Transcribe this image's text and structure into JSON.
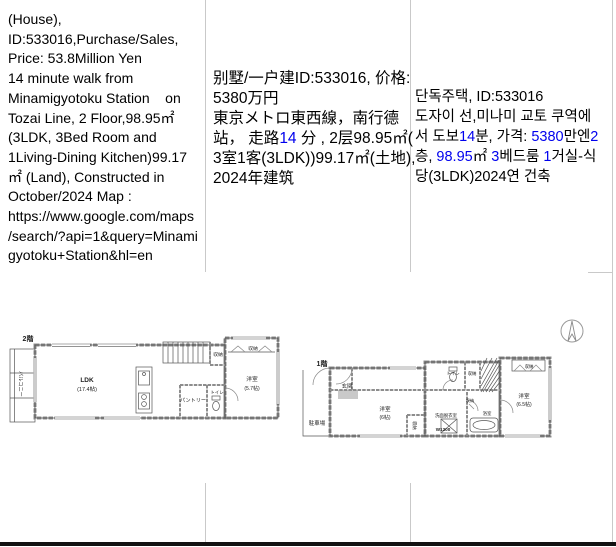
{
  "colors": {
    "text": "#000000",
    "number_link": "#0000ee",
    "grid": "#c9c9c9",
    "bottom_bar": "#121212",
    "wall": "#8d8d8d",
    "plan_line": "#555555"
  },
  "listing": {
    "id": "533016",
    "price_en": "53.8Million Yen",
    "price_local": "5380万円"
  },
  "cells": {
    "english": [
      [
        {
          "t": "(House),"
        }
      ],
      [
        {
          "t": "ID:533016,Purchase/Sales,"
        }
      ],
      [
        {
          "t": "Price: 53.8Million Yen"
        }
      ],
      [
        {
          "t": "14 minute walk from"
        }
      ],
      [
        {
          "t": "Minamigyotoku Station    on"
        }
      ],
      [
        {
          "t": "Tozai Line, 2 Floor,98.95㎡"
        }
      ],
      [
        {
          "t": "(3LDK, 3Bed Room and"
        }
      ],
      [
        {
          "t": "1Living-Dining Kitchen)99.17"
        }
      ],
      [
        {
          "t": "㎡ (Land), Constructed in"
        }
      ],
      [
        {
          "t": "October/2024 Map :"
        }
      ],
      [
        {
          "t": "https://www.google.com/maps"
        }
      ],
      [
        {
          "t": "/search/?api=1&query=Minami"
        }
      ],
      [
        {
          "t": "gyotoku+Station&hl=en"
        }
      ]
    ],
    "chinese": [
      [
        {
          "t": "别墅/一户建ID:533016, 价格:"
        }
      ],
      [
        {
          "t": "5380万円"
        }
      ],
      [
        {
          "t": "東京メトロ東西線，南行德"
        }
      ],
      [
        {
          "t": "站， 走路"
        },
        {
          "t": "14",
          "c": "b"
        },
        {
          "t": " 分 , 2层98.95㎡("
        }
      ],
      [
        {
          "t": "3室1客(3LDK))99.17㎡(土地),"
        }
      ],
      [
        {
          "t": "2024年建筑"
        }
      ]
    ],
    "korean": [
      [
        {
          "t": "단독주택, ID:533016"
        }
      ],
      [
        {
          "t": "도자이 선,미나미 교토 쿠역에"
        }
      ],
      [
        {
          "t": "서 도보"
        },
        {
          "t": "14",
          "c": "b"
        },
        {
          "t": "분, 가격: "
        },
        {
          "t": "5380",
          "c": "b"
        },
        {
          "t": "만엔"
        },
        {
          "t": "2",
          "c": "b"
        }
      ],
      [
        {
          "t": "층, "
        },
        {
          "t": "98.95",
          "c": "b"
        },
        {
          "t": "㎡ "
        },
        {
          "t": "3",
          "c": "b"
        },
        {
          "t": "베드룸 "
        },
        {
          "t": "1",
          "c": "b"
        },
        {
          "t": "거실-식"
        }
      ],
      [
        {
          "t": "당(3LDK)2024연 건축"
        }
      ]
    ]
  },
  "floorplan": {
    "plan2f": {
      "title": "2階",
      "balcony": "バルコニー",
      "ldk": "LDK",
      "ldk_size": "(17.4帖)",
      "pantry": "パントリー",
      "toilet": "トイレ",
      "closet1": "収納",
      "closet2": "収納",
      "room": "洋室",
      "room_size": "(5.7帖)"
    },
    "plan1f": {
      "title": "1階",
      "entrance": "玄関",
      "parking": "駐車場",
      "room1": "洋室",
      "room1_size": "(6帖)",
      "room1_closet": "収納",
      "toilet": "トイレ",
      "closet_top": "収納",
      "closet_mid": "収納",
      "washroom": "洗面脱衣室",
      "w1200": "W1200",
      "bath": "浴室",
      "room2": "洋室",
      "room2_size": "(6.5帖)",
      "room2_closet": "収納"
    }
  }
}
